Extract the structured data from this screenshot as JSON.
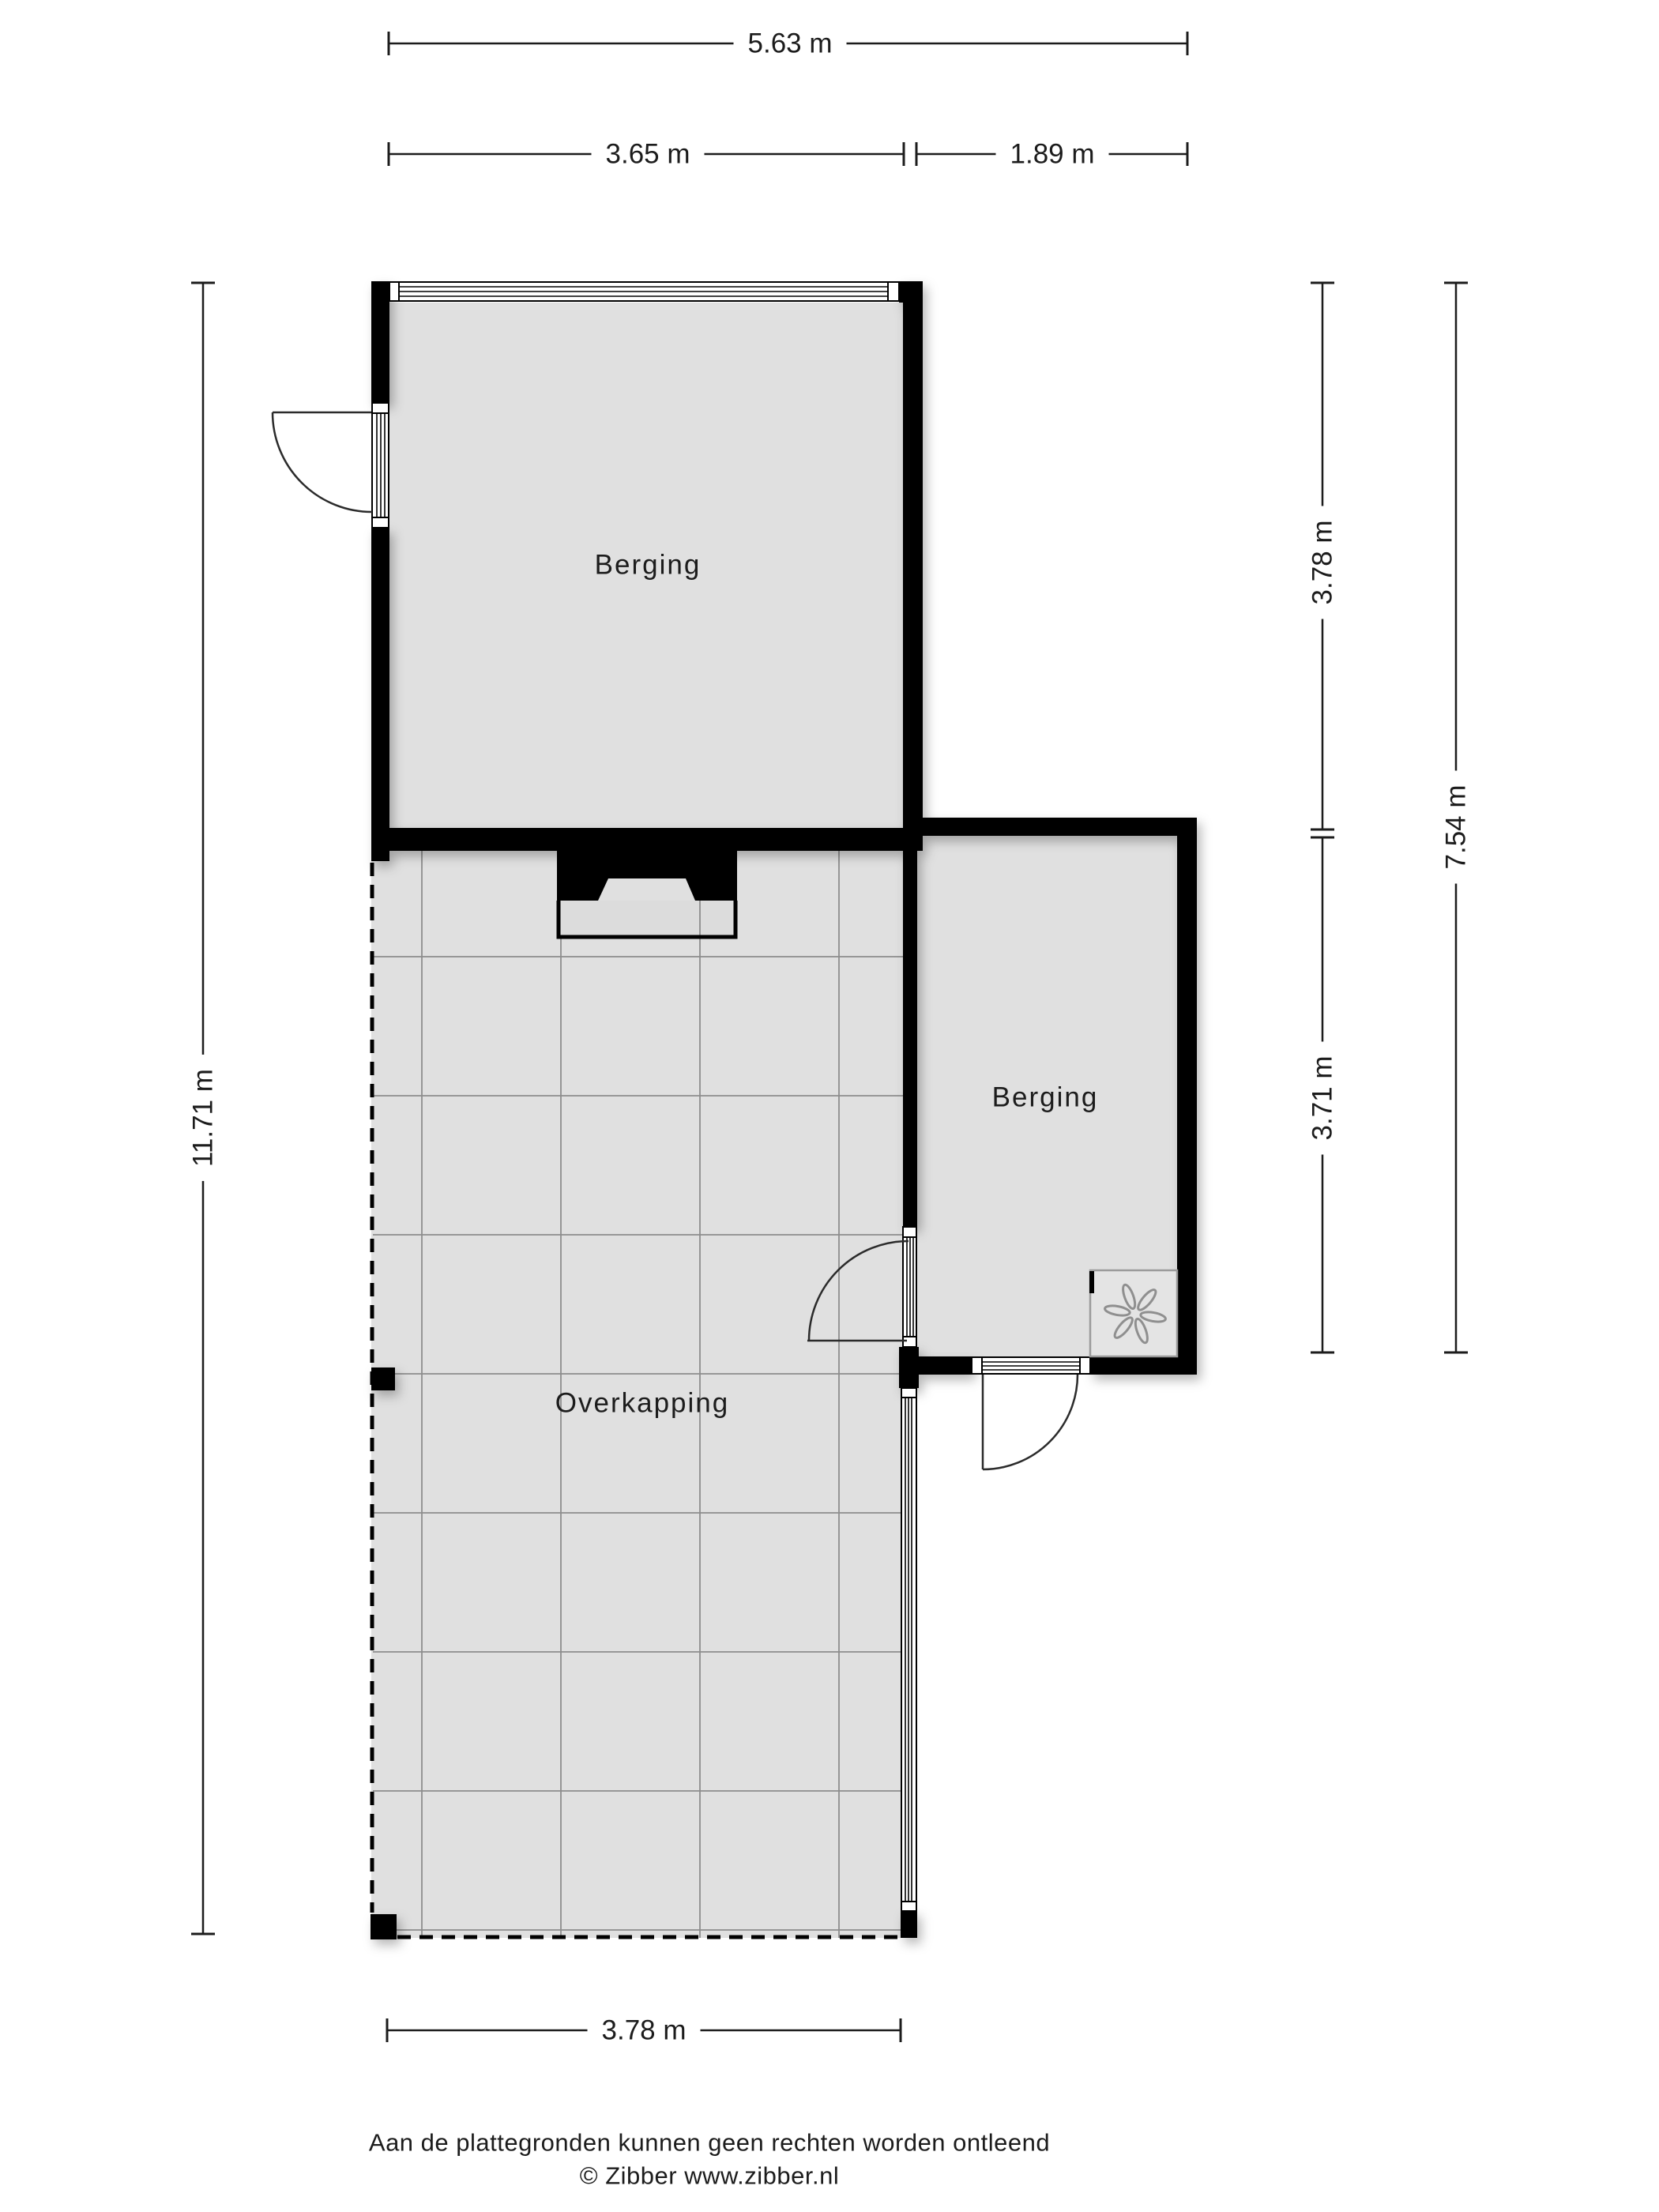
{
  "plan": {
    "rooms": [
      {
        "label": "Berging"
      },
      {
        "label": "Berging"
      },
      {
        "label": "Overkapping"
      }
    ],
    "dimensions": {
      "top_total": "5.63 m",
      "top_left": "3.65 m",
      "top_right": "1.89 m",
      "left_total": "11.71 m",
      "right_upper": "3.78 m",
      "right_lower": "3.71 m",
      "right_total": "7.54 m",
      "bottom": "3.78 m"
    },
    "footer": {
      "disclaimer": "Aan de plattegronden kunnen geen rechten worden ontleend",
      "credit": "© Zibber www.zibber.nl"
    },
    "icons": [
      {
        "name": "fan-icon"
      }
    ],
    "colors": {
      "wall": "#000000",
      "floor": "#e0e0e0",
      "grid": "#8d8d8d",
      "dimension": "#1c1c1c"
    }
  }
}
